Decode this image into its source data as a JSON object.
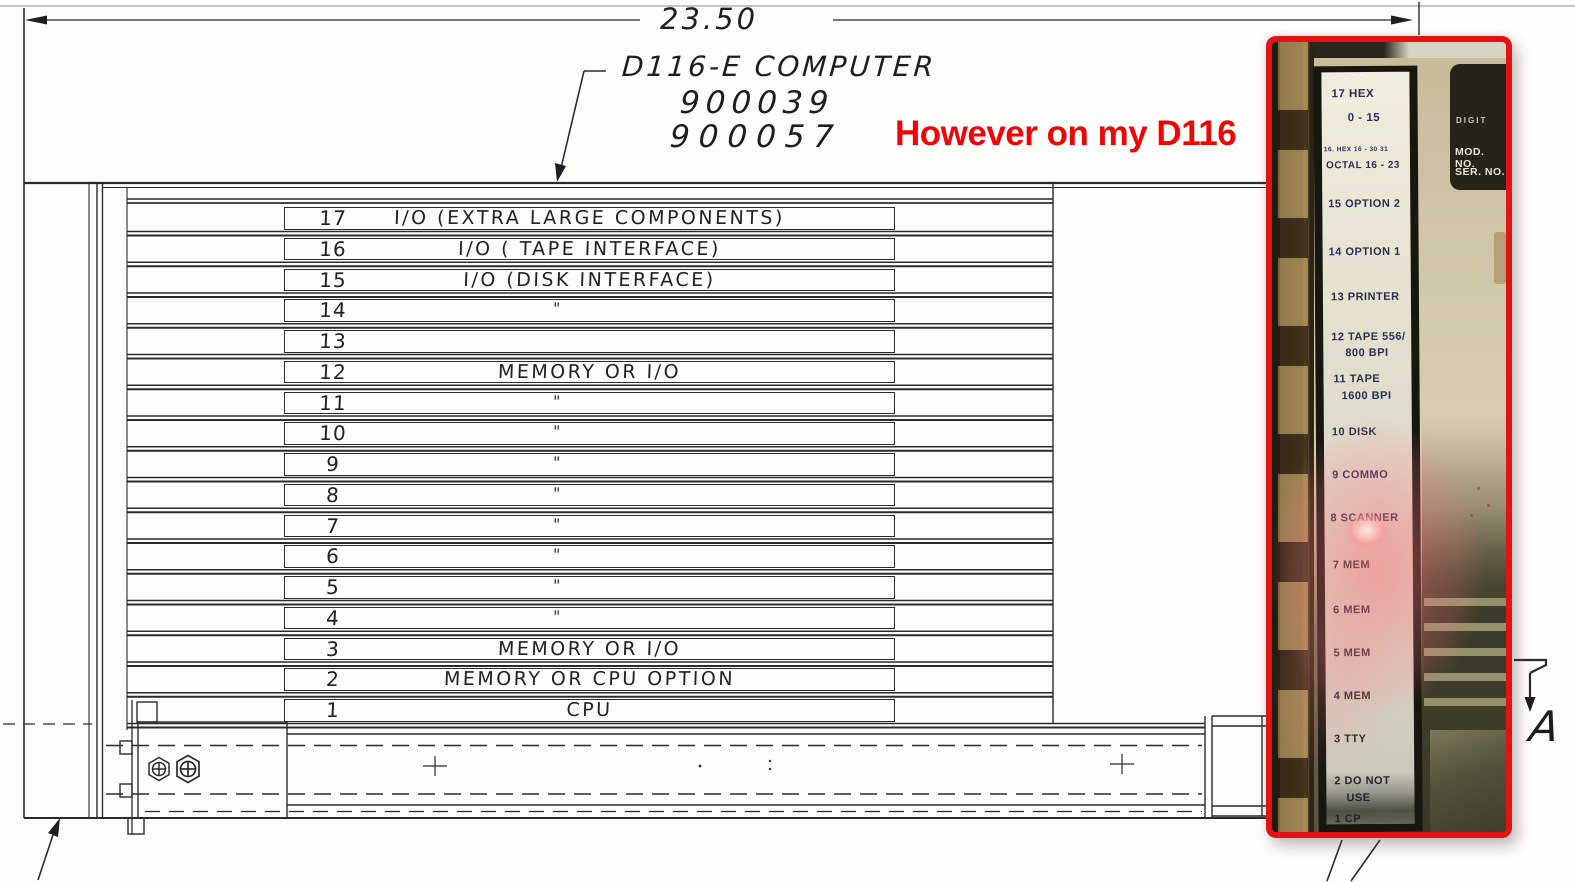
{
  "scan": {
    "dimension_label": "23.50",
    "title_line1": "D116-E COMPUTER",
    "title_code1": "900039",
    "title_code2": "900057",
    "view_label": "A",
    "slots": [
      {
        "num": "17",
        "desc": "I/O (EXTRA LARGE COMPONENTS)"
      },
      {
        "num": "16",
        "desc": "I/O ( TAPE INTERFACE)"
      },
      {
        "num": "15",
        "desc": "I/O (DISK INTERFACE)"
      },
      {
        "num": "14",
        "desc": "\""
      },
      {
        "num": "13",
        "desc": ""
      },
      {
        "num": "12",
        "desc": "MEMORY OR I/O"
      },
      {
        "num": "11",
        "desc": "\""
      },
      {
        "num": "10",
        "desc": "\""
      },
      {
        "num": "9",
        "desc": "\""
      },
      {
        "num": "8",
        "desc": "\""
      },
      {
        "num": "7",
        "desc": "\""
      },
      {
        "num": "6",
        "desc": "\""
      },
      {
        "num": "5",
        "desc": "\""
      },
      {
        "num": "4",
        "desc": "\""
      },
      {
        "num": "3",
        "desc": "MEMORY OR I/O"
      },
      {
        "num": "2",
        "desc": "MEMORY OR CPU OPTION"
      },
      {
        "num": "1",
        "desc": "CPU"
      }
    ]
  },
  "annotation": {
    "text": "However on my D116",
    "color": "#ee0505"
  },
  "photo": {
    "plate": {
      "brand": "DIGIT",
      "mod_no": "MOD. NO.",
      "ser_no": "SER. NO."
    },
    "labels": [
      "17 HEX",
      "0 - 15",
      "16. HEX 16 - 30 31",
      "OCTAL 16 - 23",
      "15 OPTION 2",
      "14 OPTION 1",
      "13 PRINTER",
      "12 TAPE 556/",
      "800 BPI",
      "11 TAPE",
      "1600 BPI",
      "10 DISK",
      "9 COMMO",
      "8 SCANNER",
      "7 MEM",
      "6 MEM",
      "5 MEM",
      "4 MEM",
      "3 TTY",
      "2 DO NOT",
      "USE",
      "1 CP"
    ]
  },
  "colors": {
    "inset_border_red": "#e31313",
    "annotation_red": "#ee0505",
    "line_ink": "#2b2b2b"
  }
}
